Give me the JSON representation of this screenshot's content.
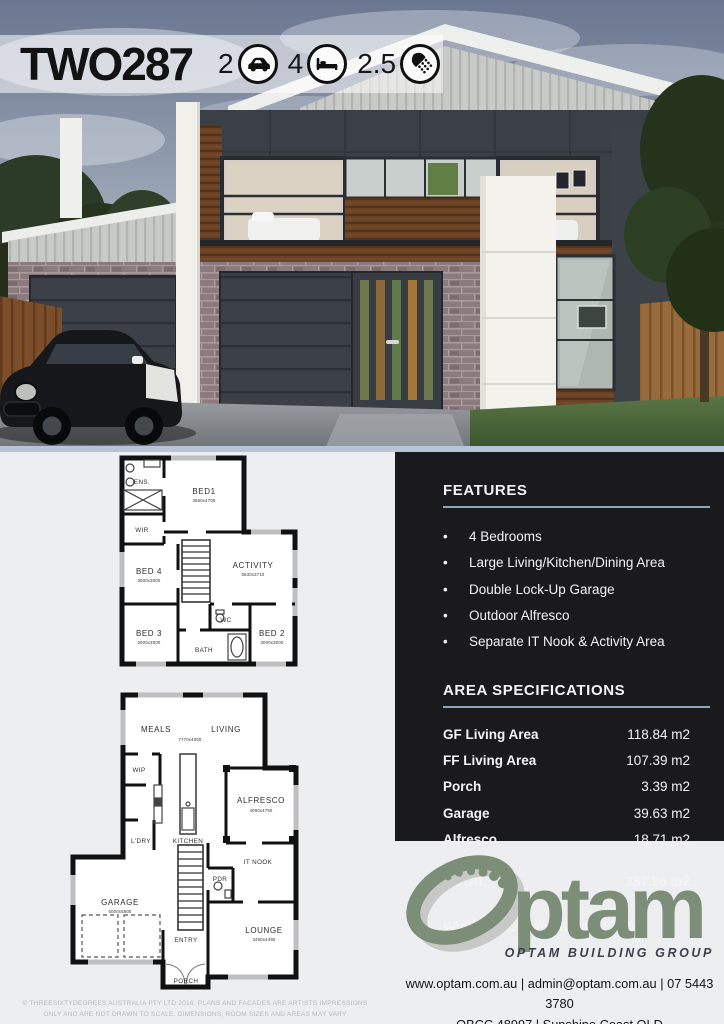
{
  "banner": {
    "model": "TWO287",
    "stats": [
      {
        "value": "2",
        "icon": "car-icon"
      },
      {
        "value": "4",
        "icon": "bed-icon"
      },
      {
        "value": "2.5",
        "icon": "shower-icon"
      }
    ]
  },
  "features": {
    "heading": "FEATURES",
    "bullet": "•",
    "items": [
      "4 Bedrooms",
      "Large Living/Kitchen/Dining Area",
      "Double Lock-Up Garage",
      "Outdoor Alfresco",
      "Separate IT Nook & Activity Area"
    ]
  },
  "area": {
    "heading": "AREA SPECIFICATIONS",
    "rows": [
      {
        "label": "GF Living Area",
        "value": "118.84 m2"
      },
      {
        "label": "FF Living Area",
        "value": "107.39 m2"
      },
      {
        "label": "Porch",
        "value": "3.39 m2"
      },
      {
        "label": "Garage",
        "value": "39.63 m2"
      },
      {
        "label": "Alfresco",
        "value": "18.71 m2"
      }
    ],
    "total_label": "TOTAL",
    "total_value": "287.96 m2",
    "width_label": "Width",
    "width_value": " 13.29m ",
    "and_text": "and",
    "depth_label": " Depth",
    "depth_value": " 17.08m"
  },
  "plans": {
    "ff": {
      "ens": {
        "name": "ENS."
      },
      "bed1": {
        "name": "BED1",
        "dim": "3650x4700"
      },
      "wir": {
        "name": "WIR"
      },
      "bed4": {
        "name": "BED 4",
        "dim": "3000x3000"
      },
      "activity": {
        "name": "ACTIVITY",
        "dim": "5630x3710"
      },
      "wc": {
        "name": "WC"
      },
      "bath": {
        "name": "BATH"
      },
      "bed3": {
        "name": "BED 3",
        "dim": "3000x3000"
      },
      "bed2": {
        "name": "BED 2",
        "dim": "3000x3000"
      }
    },
    "gf": {
      "meals": {
        "name": "MEALS"
      },
      "living": {
        "name": "LIVING"
      },
      "meals_living_dim": "7770x4000",
      "wip": {
        "name": "WIP"
      },
      "kitchen": {
        "name": "KITCHEN"
      },
      "ldry": {
        "name": "L'DRY"
      },
      "alfresco": {
        "name": "ALFRESCO",
        "dim": "4090x4750"
      },
      "itnook": {
        "name": "IT NOOK"
      },
      "pdr": {
        "name": "PDR"
      },
      "garage": {
        "name": "GARAGE",
        "dim": "6000x5800"
      },
      "entry": {
        "name": "ENTRY"
      },
      "porch": {
        "name": "PORCH"
      },
      "lounge": {
        "name": "LOUNGE",
        "dim": "3490x4490"
      }
    }
  },
  "brand": {
    "logo_text": "ptam",
    "tagline": "OPTAM BUILDING GROUP",
    "contact_line1": "www.optam.com.au | admin@optam.com.au | 07 5443 3780",
    "contact_line2": "QBCC 48997 | Sunshine Coast QLD"
  },
  "footer": {
    "line1": "© THREESIXTYDEGREES AUSTRALIA PTY LTD 2016.  PLANS AND FACADES ARE ARTISTS IMPRESSIONS",
    "line2": "ONLY AND ARE NOT DRAWN TO SCALE.  DIMENSIONS, ROOM SIZES AND AREAS MAY VARY"
  },
  "colors": {
    "panel_bg": "#1a1a1c",
    "heading_underline": "#8ca4bc",
    "logo_green": "#7d8e78",
    "cladding_dark": "#3b3f46",
    "wood": "#6b4226",
    "brick": "#8b7a7e",
    "divider_band": "#b7c3d6"
  }
}
